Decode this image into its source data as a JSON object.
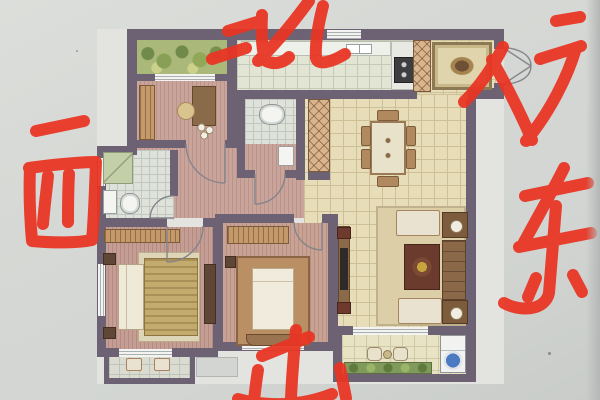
{
  "photo": {
    "paper_color": "#d5d7d3",
    "edge_shadow_color": "#b4b7b5"
  },
  "annotations": {
    "ink_color": "#e93524",
    "items": [
      {
        "id": "north",
        "char": "北",
        "label": "north"
      },
      {
        "id": "west",
        "char": "西",
        "label": "west"
      },
      {
        "id": "east",
        "char": "东",
        "label": "east"
      },
      {
        "id": "south",
        "char": "南",
        "label": "south"
      },
      {
        "id": "entry",
        "char": "入户",
        "label": "entry door"
      }
    ]
  },
  "floorplan": {
    "wall_color": "#6d6274",
    "rooms": [
      {
        "id": "north-balcony",
        "label": "north balcony with plants"
      },
      {
        "id": "bedroom-north",
        "label": "north bedroom / study"
      },
      {
        "id": "bathroom-west",
        "label": "west bathroom"
      },
      {
        "id": "bathroom-center",
        "label": "center bathroom"
      },
      {
        "id": "kitchen",
        "label": "kitchen"
      },
      {
        "id": "entry-foyer",
        "label": "entry foyer with rug"
      },
      {
        "id": "living-dining",
        "label": "living and dining room"
      },
      {
        "id": "hallway",
        "label": "hallway"
      },
      {
        "id": "master-bedroom",
        "label": "master bedroom"
      },
      {
        "id": "bedroom-south",
        "label": "south bedroom"
      },
      {
        "id": "master-balcony",
        "label": "small bedroom balcony"
      },
      {
        "id": "south-balcony",
        "label": "south balcony with laundry"
      }
    ],
    "furniture": [
      "wardrobe",
      "desk",
      "round-chair",
      "shower",
      "wash-basin",
      "toilet",
      "kitchen-counter",
      "kitchen-sink",
      "stove",
      "entry-rug",
      "dining-table",
      "dining-chairs",
      "display-column",
      "tv-console",
      "tv",
      "sofa",
      "loveseat",
      "armchair",
      "coffee-table",
      "lamp-side-table",
      "double-bed",
      "nightstand",
      "dresser",
      "lounge-chairs",
      "bistro-set",
      "washing-machine",
      "planter-box"
    ]
  }
}
